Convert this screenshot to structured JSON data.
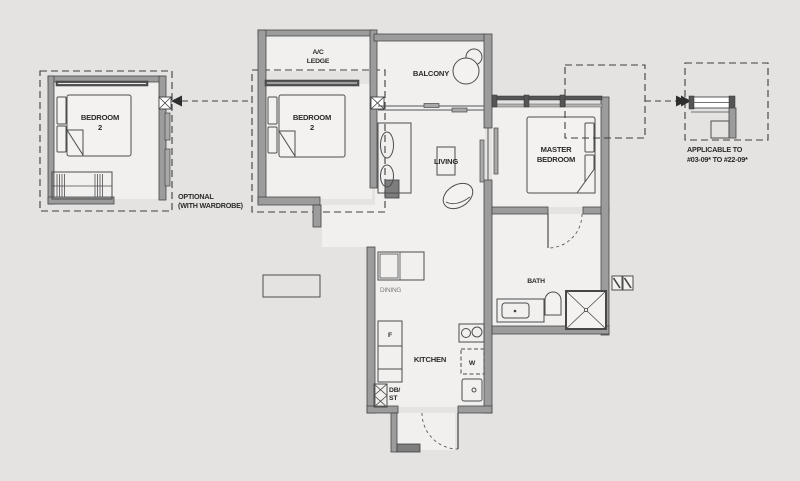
{
  "page": {
    "background": "#e4e3e1"
  },
  "colors": {
    "wall": "#9c9c9c",
    "wall_outline": "#474747",
    "window_bar": "#555555",
    "line": "#4d4d4d",
    "text": "#2b2b2b",
    "floor": "#f1f0ee"
  },
  "labels": {
    "optional_room": {
      "name_line1": "BEDROOM",
      "name_line2": "2",
      "note_line1": "OPTIONAL",
      "note_line2": "(WITH WARDROBE)"
    },
    "ac_ledge": {
      "line1": "A/C",
      "line2": "LEDGE"
    },
    "balcony": "BALCONY",
    "bedroom2": {
      "line1": "BEDROOM",
      "line2": "2"
    },
    "living": "LIVING",
    "dining": "DINING",
    "master": {
      "line1": "MASTER",
      "line2": "BEDROOM"
    },
    "bath": "BATH",
    "kitchen": "KITCHEN",
    "fridge": "F",
    "washer": "W",
    "db": {
      "line1": "DB/",
      "line2": "ST"
    },
    "applicable": {
      "line1": "APPLICABLE TO",
      "line2": "#03-09* TO #22-09*"
    }
  }
}
